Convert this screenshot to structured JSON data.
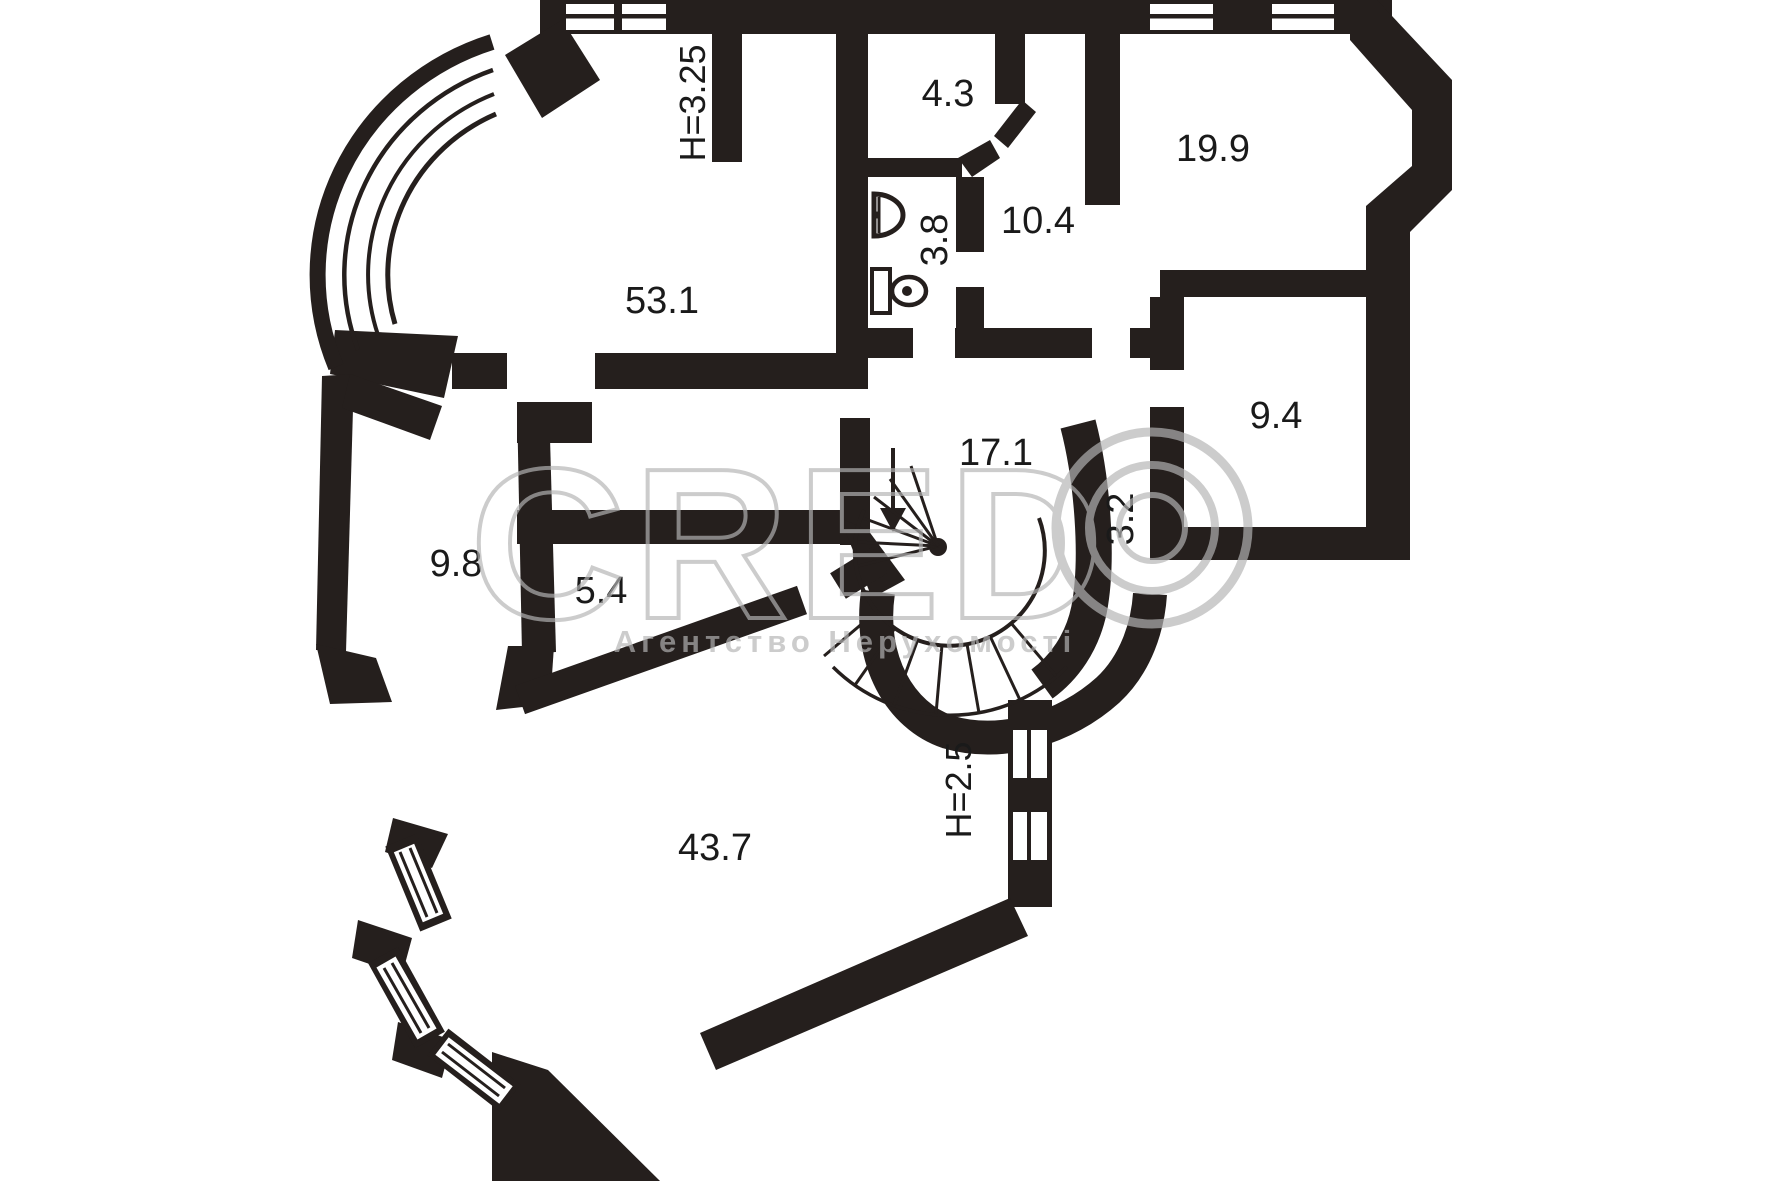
{
  "floorplan": {
    "type": "apartment-floor-plan",
    "units": "m2",
    "wall_color": "#251f1d",
    "label_color": "#1a1a1a",
    "watermark_color": "#b5b5b5",
    "rooms": [
      {
        "id": "room-53-1",
        "area": "53.1"
      },
      {
        "id": "room-4-3",
        "area": "4.3"
      },
      {
        "id": "room-3-8",
        "area": "3.8"
      },
      {
        "id": "room-10-4",
        "area": "10.4"
      },
      {
        "id": "room-19-9",
        "area": "19.9"
      },
      {
        "id": "room-9-4",
        "area": "9.4"
      },
      {
        "id": "room-17-1",
        "area": "17.1"
      },
      {
        "id": "room-3-2",
        "area": "3.2"
      },
      {
        "id": "room-9-8",
        "area": "9.8"
      },
      {
        "id": "room-5-4",
        "area": "5.4"
      },
      {
        "id": "room-43-7",
        "area": "43.7"
      }
    ],
    "height_labels": [
      {
        "id": "ceiling-upper",
        "text": "H=3.25"
      },
      {
        "id": "ceiling-lower",
        "text": "H=2.5"
      }
    ],
    "watermark": {
      "letters": "CRED",
      "agency": "Агентство Нерухомості"
    }
  }
}
